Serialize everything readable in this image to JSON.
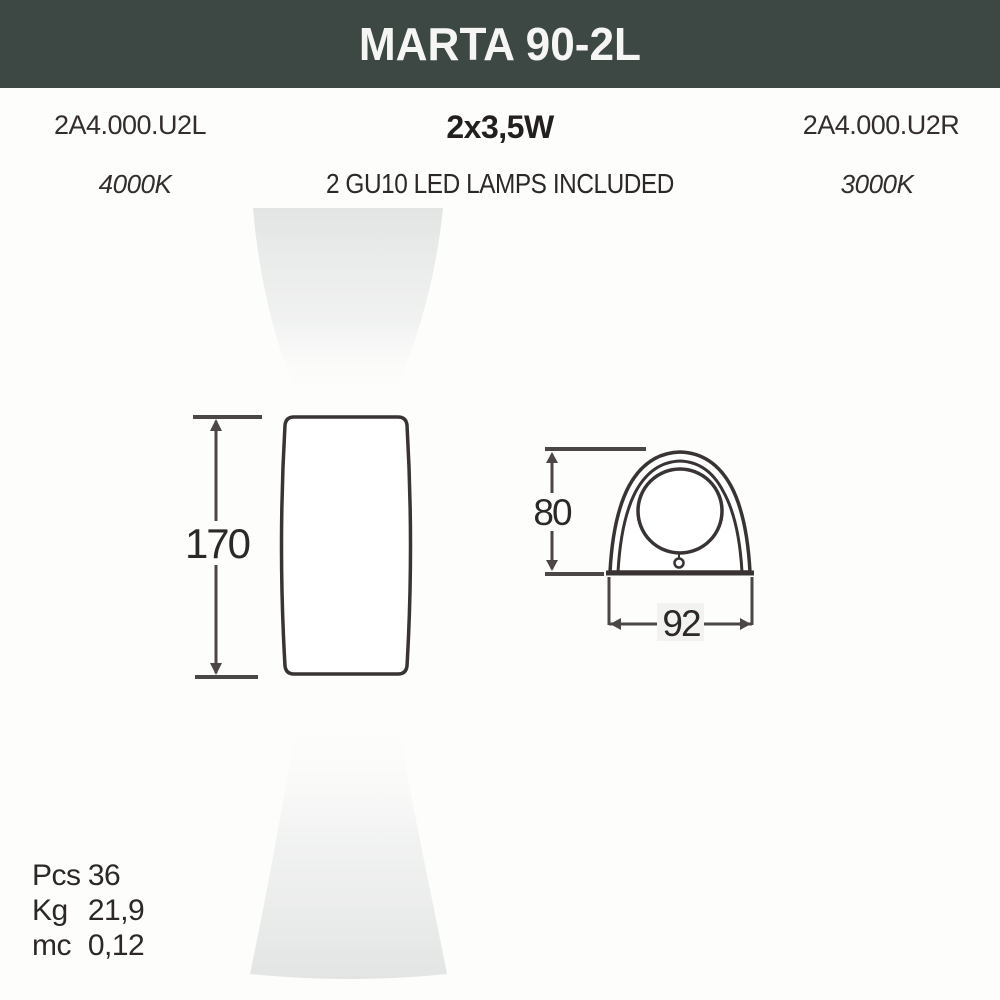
{
  "header": {
    "title": "MARTA 90-2L"
  },
  "info": {
    "left": {
      "code": "2A4.000.U2L",
      "temp": "4000K"
    },
    "center": {
      "wattage": "2x3,5W",
      "lamps": "2 GU10 LED LAMPS INCLUDED"
    },
    "right": {
      "code": "2A4.000.U2R",
      "temp": "3000K"
    }
  },
  "drawings": {
    "front_view": {
      "height_mm": "170"
    },
    "side_view": {
      "height_mm": "80",
      "width_mm": "92"
    }
  },
  "packaging": {
    "rows": [
      {
        "label": "Pcs",
        "value": "36"
      },
      {
        "label": "Kg",
        "value": "21,9"
      },
      {
        "label": "mc",
        "value": "0,12"
      }
    ]
  },
  "colors": {
    "header_bg": "#3d4845",
    "title_text": "#f5f6f4",
    "beam_grey": "#e3e5e4",
    "line_dark": "#393334",
    "dim_line": "#4c4747",
    "text_dark": "#2c2827",
    "page_bg": "#fdfdfb"
  }
}
